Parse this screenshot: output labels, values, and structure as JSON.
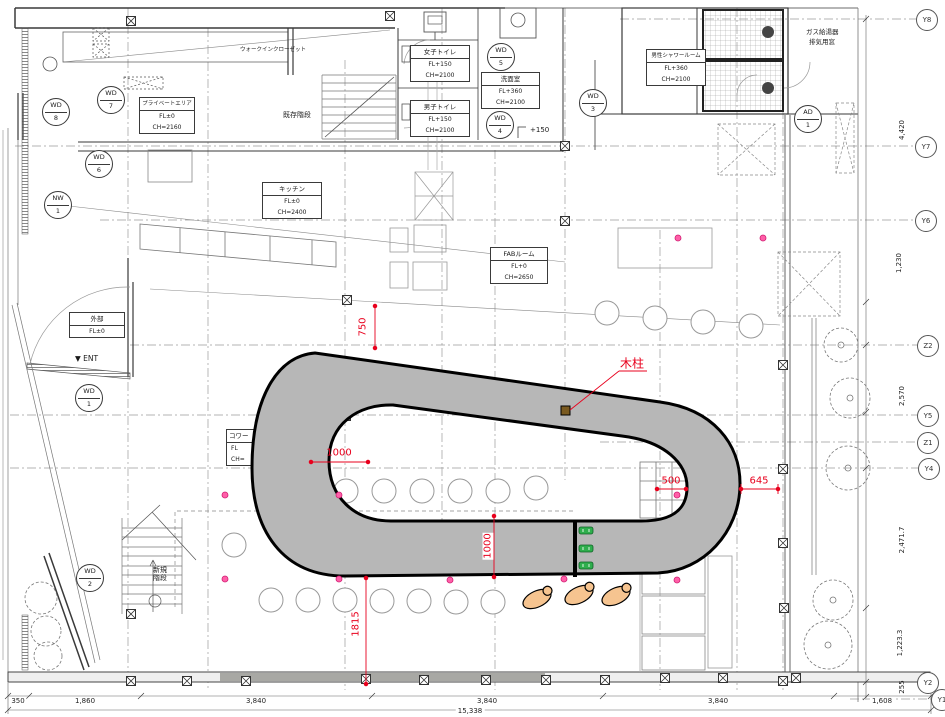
{
  "colors": {
    "band_gray": "#b7b7b7",
    "dim_red": "#e8001d",
    "marker_pink": "#ff5fa8",
    "item_green": "#2fae4d",
    "wood_brown": "#7a5a20",
    "person_tan": "#f6c490"
  },
  "rooms": [
    {
      "name": "プライベートエリア",
      "fl": "FL±0",
      "ch": "CH=2160"
    },
    {
      "name": "女子トイレ",
      "fl": "FL+150",
      "ch": "CH=2100"
    },
    {
      "name": "男子トイレ",
      "fl": "FL+150",
      "ch": "CH=2100"
    },
    {
      "name": "洗面室",
      "fl": "FL+360",
      "ch": "CH=2100"
    },
    {
      "name": "男性シャワールーム",
      "fl": "FL+360",
      "ch": "CH=2100"
    },
    {
      "name": "キッチン",
      "fl": "FL±0",
      "ch": "CH=2400"
    },
    {
      "name": "FABルーム",
      "fl": "FL+0",
      "ch": "CH=2650"
    },
    {
      "name": "外部",
      "fl": "FL±0",
      "ch": ""
    },
    {
      "name": "コワー",
      "fl": "FL",
      "ch": "CH="
    }
  ],
  "annotations": {
    "walk_in_closet": "ウォークインクローゼット",
    "existing_stairs": "既存階段",
    "new_stairs": "新規階段",
    "entrance": "▼ ENT",
    "gas_heater_1": "ガス給湯器",
    "gas_heater_2": "排気用窓",
    "step_150": "+150",
    "wood_post": "木柱"
  },
  "door_window_marks": [
    {
      "code": "WD",
      "num": "8"
    },
    {
      "code": "WD",
      "num": "7"
    },
    {
      "code": "WD",
      "num": "6"
    },
    {
      "code": "NW",
      "num": "1"
    },
    {
      "code": "WD",
      "num": "5"
    },
    {
      "code": "WD",
      "num": "4"
    },
    {
      "code": "WD",
      "num": "3"
    },
    {
      "code": "AD",
      "num": "1"
    },
    {
      "code": "WD",
      "num": "1"
    },
    {
      "code": "WD",
      "num": "2"
    }
  ],
  "grid_labels": [
    "Y8",
    "Y7",
    "Y6",
    "Z2",
    "Y5",
    "Z1",
    "Y4",
    "Y2",
    "Y1"
  ],
  "dimensions": {
    "bottom_row": [
      "350",
      "1,860",
      "3,840",
      "3,840",
      "3,840",
      "1,608"
    ],
    "bottom_total": "15,338",
    "right_column": [
      "4,420",
      "1,230",
      "2,570",
      "2,471.7",
      "1,223.3",
      "255"
    ],
    "red": {
      "top": "750",
      "left": "1000",
      "mid_vert": "1000",
      "inner_right": "500",
      "outer_right": "645",
      "bottom": "1815"
    }
  }
}
